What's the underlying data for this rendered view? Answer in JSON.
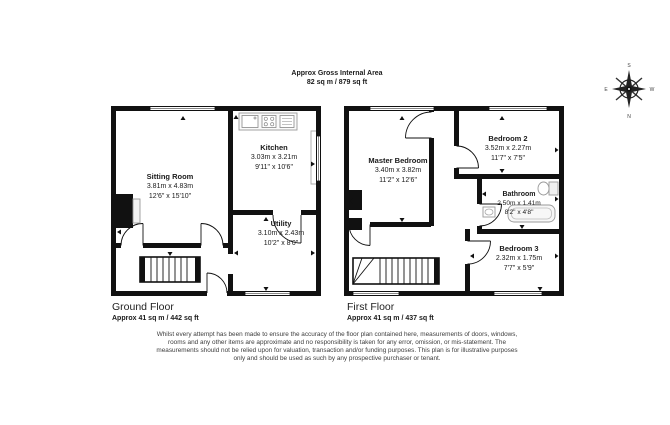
{
  "header": {
    "title": "Approx Gross Internal Area",
    "area": "82 sq m / 879 sq ft"
  },
  "compass": {
    "top": "S",
    "bottom": "N",
    "left": "E",
    "right": "W"
  },
  "floors": [
    {
      "name": "Ground Floor",
      "area": "Approx 41 sq m / 442 sq ft",
      "rooms": [
        {
          "name": "Sitting Room",
          "metric": "3.81m x 4.83m",
          "imperial": "12'6\" x 15'10\""
        },
        {
          "name": "Kitchen",
          "metric": "3.03m x 3.21m",
          "imperial": "9'11\" x 10'6\""
        },
        {
          "name": "Utility",
          "metric": "3.10m x 2.43m",
          "imperial": "10'2\" x 8'0\""
        }
      ]
    },
    {
      "name": "First Floor",
      "area": "Approx 41 sq m / 437 sq ft",
      "rooms": [
        {
          "name": "Master Bedroom",
          "metric": "3.40m x 3.82m",
          "imperial": "11'2\" x 12'6\""
        },
        {
          "name": "Bedroom 2",
          "metric": "3.52m x 2.27m",
          "imperial": "11'7\" x 7'5\""
        },
        {
          "name": "Bathroom",
          "metric": "2.50m x 1.41m",
          "imperial": "8'2\" x 4'8\""
        },
        {
          "name": "Bedroom 3",
          "metric": "2.32m x 1.75m",
          "imperial": "7'7\" x 5'9\""
        }
      ]
    }
  ],
  "disclaimer": "Whilst every attempt has been made to ensure the accuracy of the floor plan contained here, measurements of doors, windows, rooms and any other items are approximate and no responsibility is taken for any error, omission, or mis-statement. The measurements should not be relied upon for valuation, transaction and/or funding purposes. This plan is for illustrative purposes only and should be used as such by any prospective purchaser or tenant.",
  "colors": {
    "wall": "#111111",
    "text": "#1a1a1a",
    "muted": "#3d3d3d"
  }
}
